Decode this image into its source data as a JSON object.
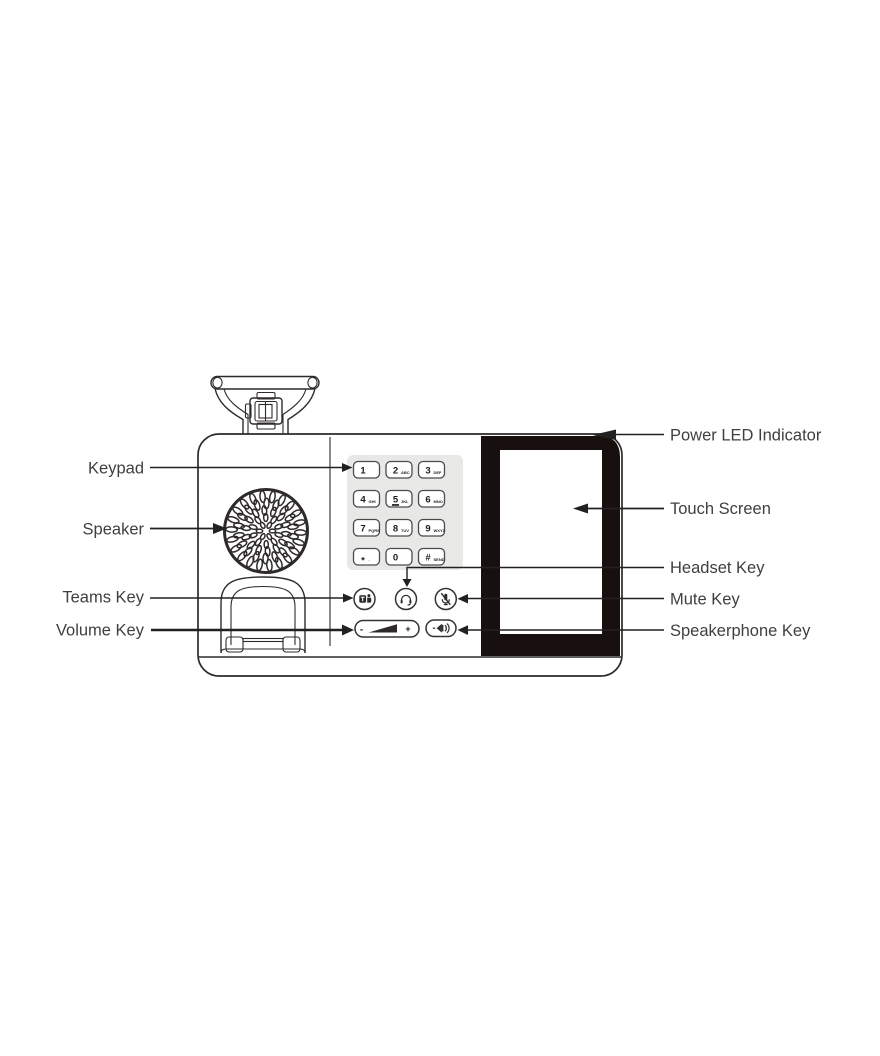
{
  "callouts": {
    "left": [
      {
        "label": "Keypad"
      },
      {
        "label": "Speaker"
      },
      {
        "label": "Teams Key"
      },
      {
        "label": "Volume Key"
      }
    ],
    "right": [
      {
        "label": "Power LED Indicator"
      },
      {
        "label": "Touch Screen"
      },
      {
        "label": "Headset Key"
      },
      {
        "label": "Mute Key"
      },
      {
        "label": "Speakerphone Key"
      }
    ]
  },
  "keypad": {
    "keys": [
      {
        "digit": "1",
        "letters": ""
      },
      {
        "digit": "2",
        "letters": "ABC"
      },
      {
        "digit": "3",
        "letters": "DEF"
      },
      {
        "digit": "4",
        "letters": "GHI"
      },
      {
        "digit": "5",
        "letters": "JKL"
      },
      {
        "digit": "6",
        "letters": "MNO"
      },
      {
        "digit": "7",
        "letters": "PQRS"
      },
      {
        "digit": "8",
        "letters": "TUV"
      },
      {
        "digit": "9",
        "letters": "WXYZ"
      },
      {
        "digit": "*",
        "letters": "."
      },
      {
        "digit": "0",
        "letters": ""
      },
      {
        "digit": "#",
        "letters": "SEND"
      }
    ]
  },
  "volume_key": {
    "minus": "-",
    "plus": "+"
  },
  "icons": {
    "teams": "teams-logo-icon",
    "headset": "headset-icon",
    "mute": "mic-muted-icon",
    "speakerphone": "speaker-waves-icon",
    "volume": "volume-wedge-icon",
    "speaker_grille": "speaker-grille"
  },
  "colors": {
    "line": "#2e2a2b",
    "bezel": "#18100f",
    "keypad_panel": "#e8e8e7",
    "label_text": "#3f3f3f"
  }
}
